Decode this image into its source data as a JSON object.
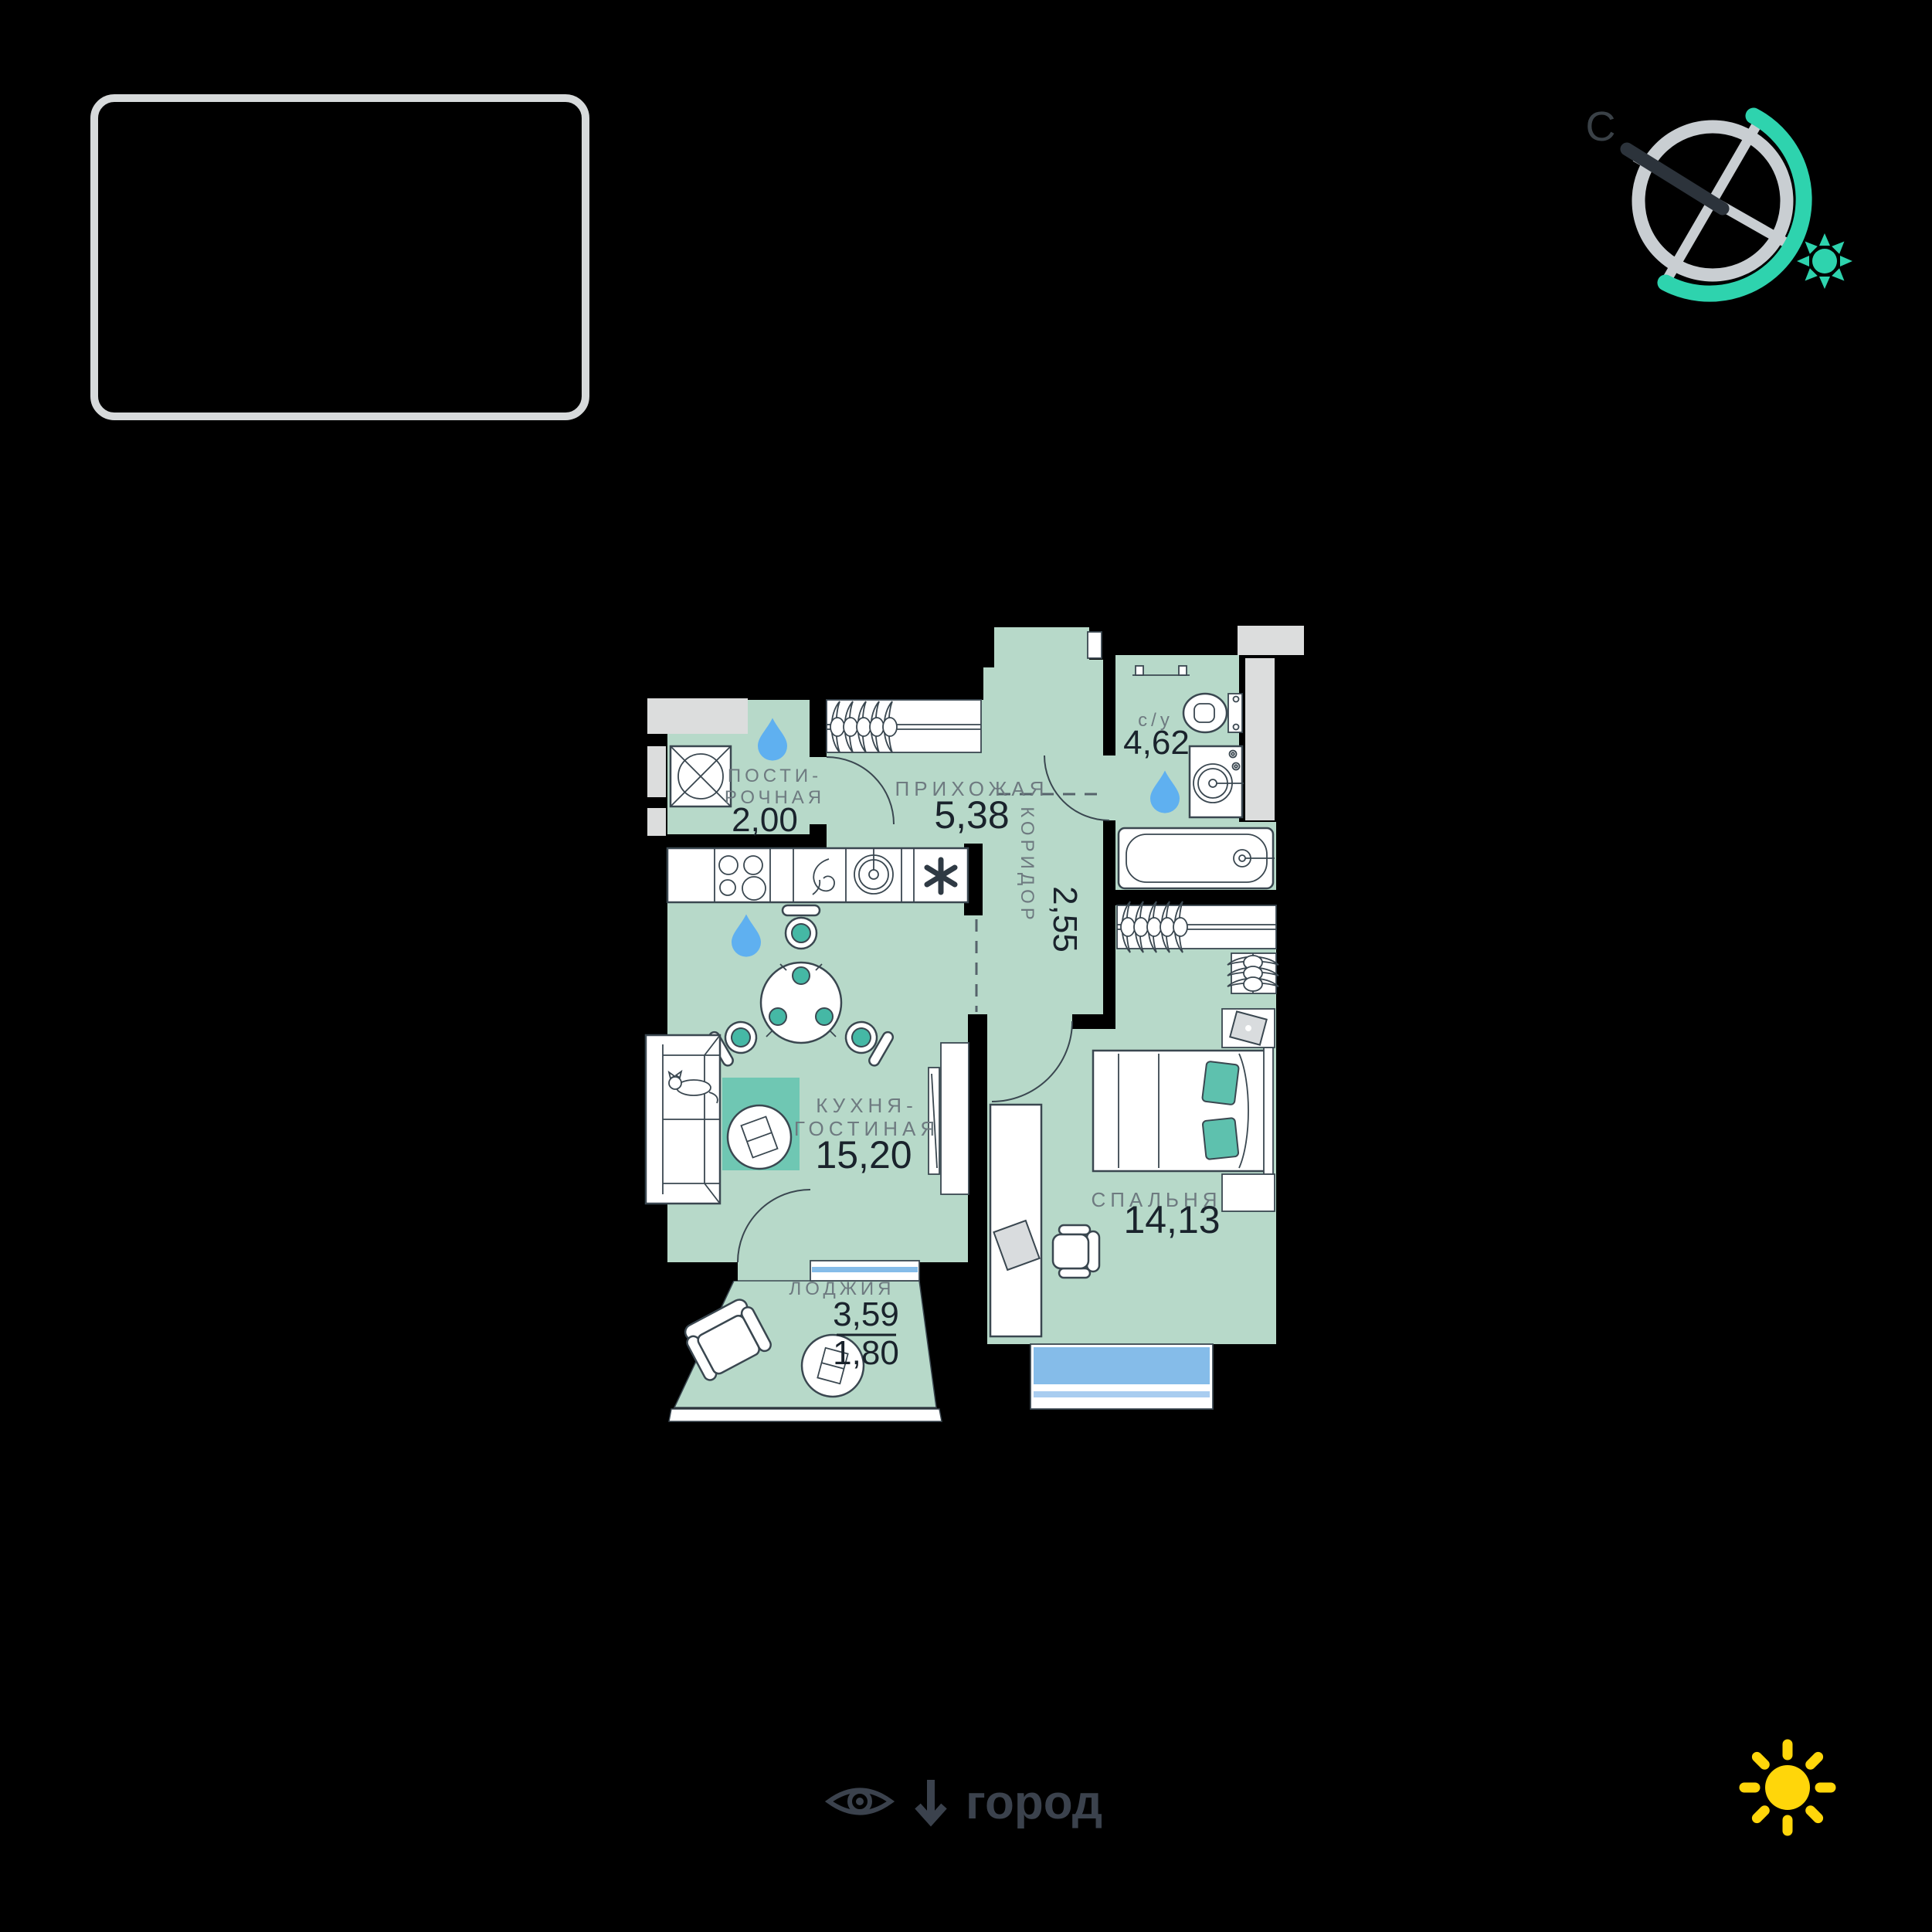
{
  "compass": {
    "north_label": "С"
  },
  "legend": {
    "view_direction_label": "город"
  },
  "rooms": {
    "laundry": {
      "name_line1": "ПОСТИ-",
      "name_line2": "РОЧНАЯ",
      "area": "2,00"
    },
    "hallway": {
      "name": "ПРИХОЖАЯ",
      "area": "5,38"
    },
    "bathroom": {
      "name": "с/у",
      "area": "4,62"
    },
    "corridor": {
      "name": "КОРИДОР",
      "area": "2,55"
    },
    "kitchen_living": {
      "name_line1": "КУХНЯ-",
      "name_line2": "ГОСТИНАЯ",
      "area": "15,20"
    },
    "loggia": {
      "name": "ЛОДЖИЯ",
      "area_full": "3,59",
      "area_counted": "1,80"
    },
    "bedroom": {
      "name": "СПАЛЬНЯ",
      "area": "14,13"
    }
  },
  "colors": {
    "background": "#000000",
    "floor": "#b7d9c9",
    "walls": "#000000",
    "fixture_stroke": "#3a4750",
    "shaft_gray": "#dcdddd",
    "accent_teal": "#6fc7b3",
    "pillow_teal": "#5ec1ae",
    "water_drop_blue": "#5fb0f0",
    "window_blue": "#85bce9",
    "compass_teal": "#2ed3ae",
    "compass_gray": "#c9ced2",
    "label_gray": "#6e7a80",
    "value_dark": "#1a232c",
    "legend_dark": "#3b424d",
    "sun_yellow": "#ffd60a",
    "frame_border": "#d7dadb"
  }
}
